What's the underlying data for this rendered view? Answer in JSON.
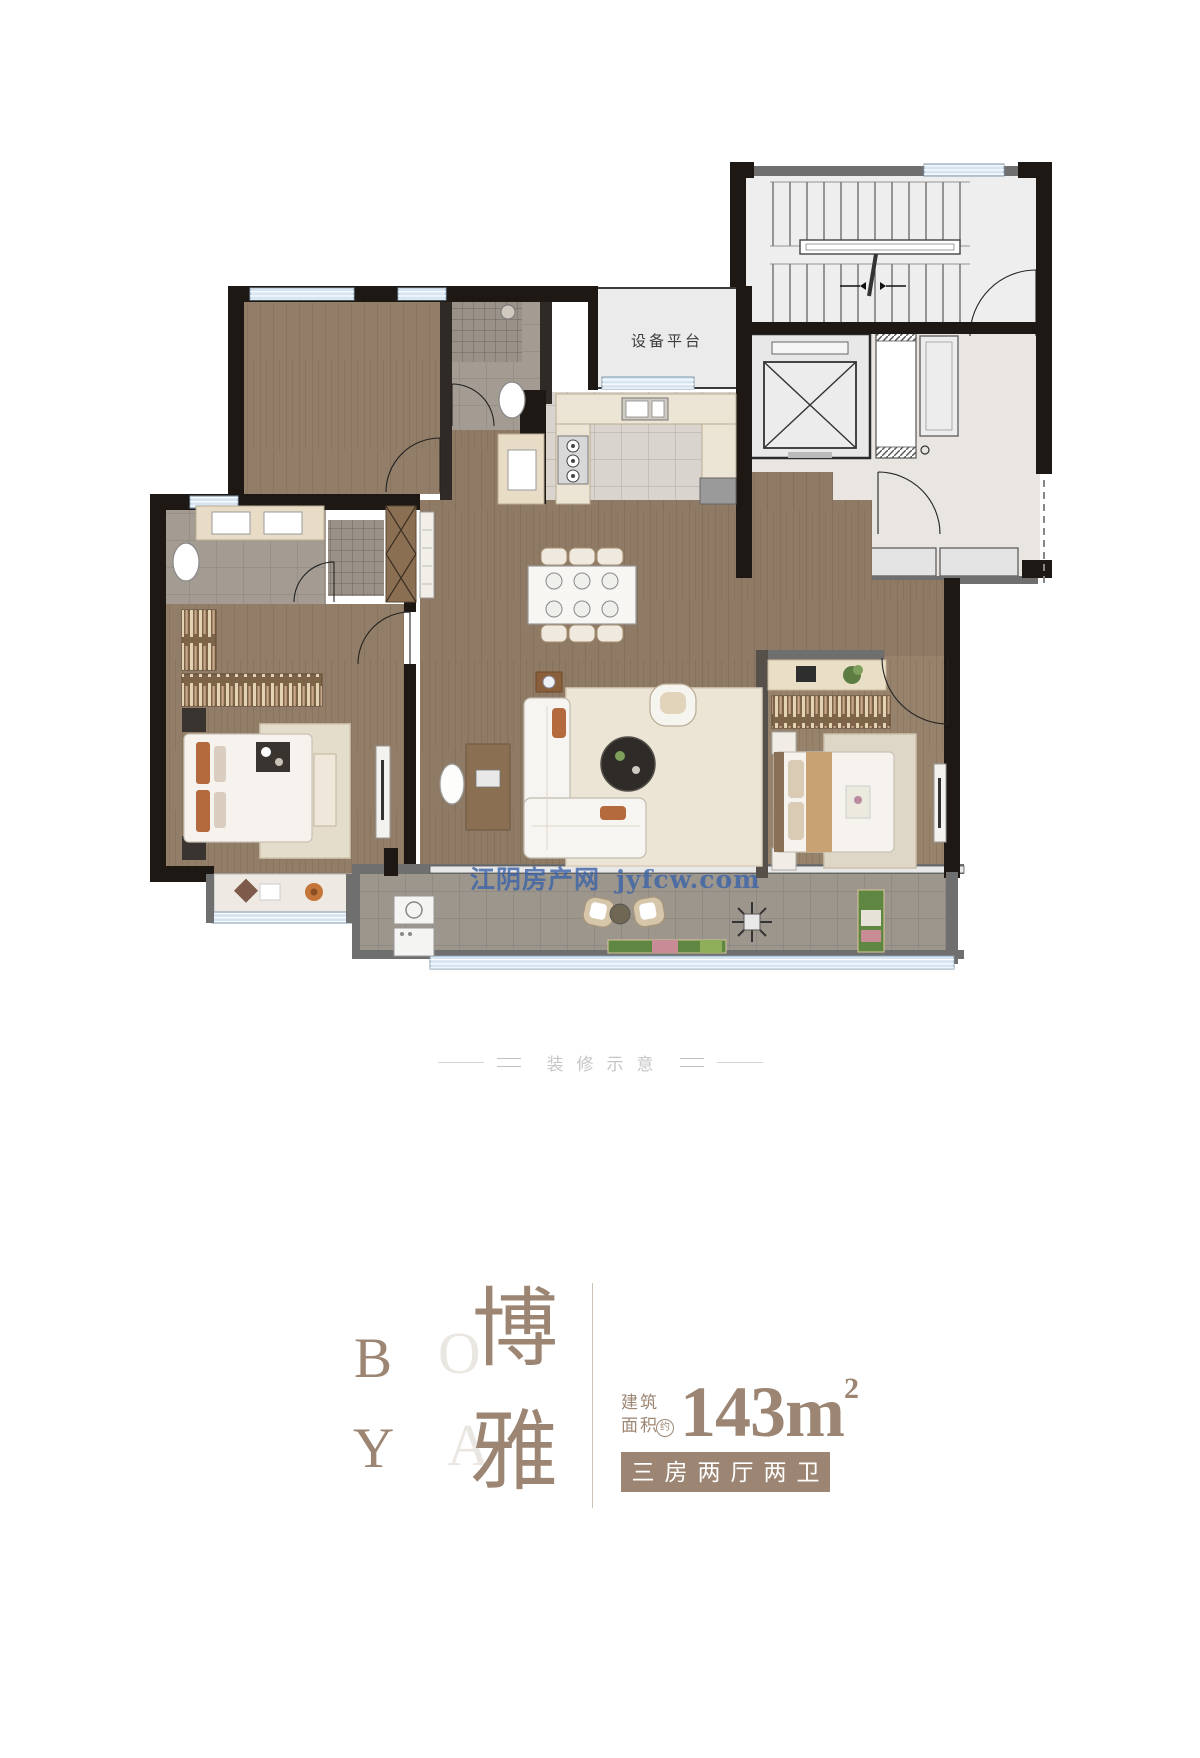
{
  "floorplan": {
    "equipment_platform_label": "设备平台"
  },
  "watermark": {
    "site_name": "江阴房产网",
    "domain": "jyfcw.com",
    "color": "#3b63a8"
  },
  "caption": {
    "text": "装修示意"
  },
  "brand": {
    "letter_b": "B",
    "letter_o": "O",
    "letter_y": "Y",
    "letter_a": "A",
    "hanzi_top": "博",
    "hanzi_bottom": "雅"
  },
  "area": {
    "label_line1": "建筑",
    "label_line2": "面积",
    "approx_mark": "约",
    "value": "143",
    "unit": "m",
    "superscript": "2"
  },
  "layout_tag": {
    "text": "三房两厅两卫"
  },
  "colors": {
    "brand_brown": "#9c8673",
    "light_letter": "#eae6e1",
    "watermark_blue": "#3b63a8",
    "wall_dark": "#1d1814",
    "wall_gray": "#6f6f6f",
    "wood_floor": "#8e7a65",
    "tile_gray": "#a49c93",
    "marble_light": "#e8e5e1",
    "window_blue": "#d6e5f1",
    "counter_beige": "#ece4d4",
    "shelf_brown": "#7d6348",
    "accent_orange": "#b56a3e"
  }
}
